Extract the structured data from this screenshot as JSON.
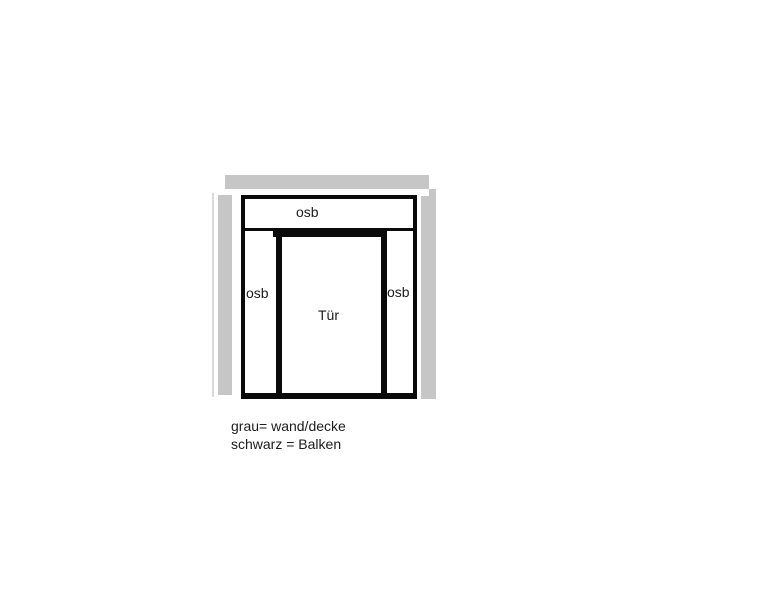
{
  "diagram": {
    "labels": {
      "osb_top": "osb",
      "osb_left": "osb",
      "osb_right": "osb",
      "door": "Tür"
    },
    "legend": {
      "line1": "grau= wand/decke",
      "line2": "schwarz = Balken"
    },
    "colors": {
      "wall_gray": "#c6c6c6",
      "wall_gray_light": "#d9d9d9",
      "beam_black": "#0a0a0a",
      "text": "#1c1c1c",
      "background": "#ffffff"
    }
  }
}
